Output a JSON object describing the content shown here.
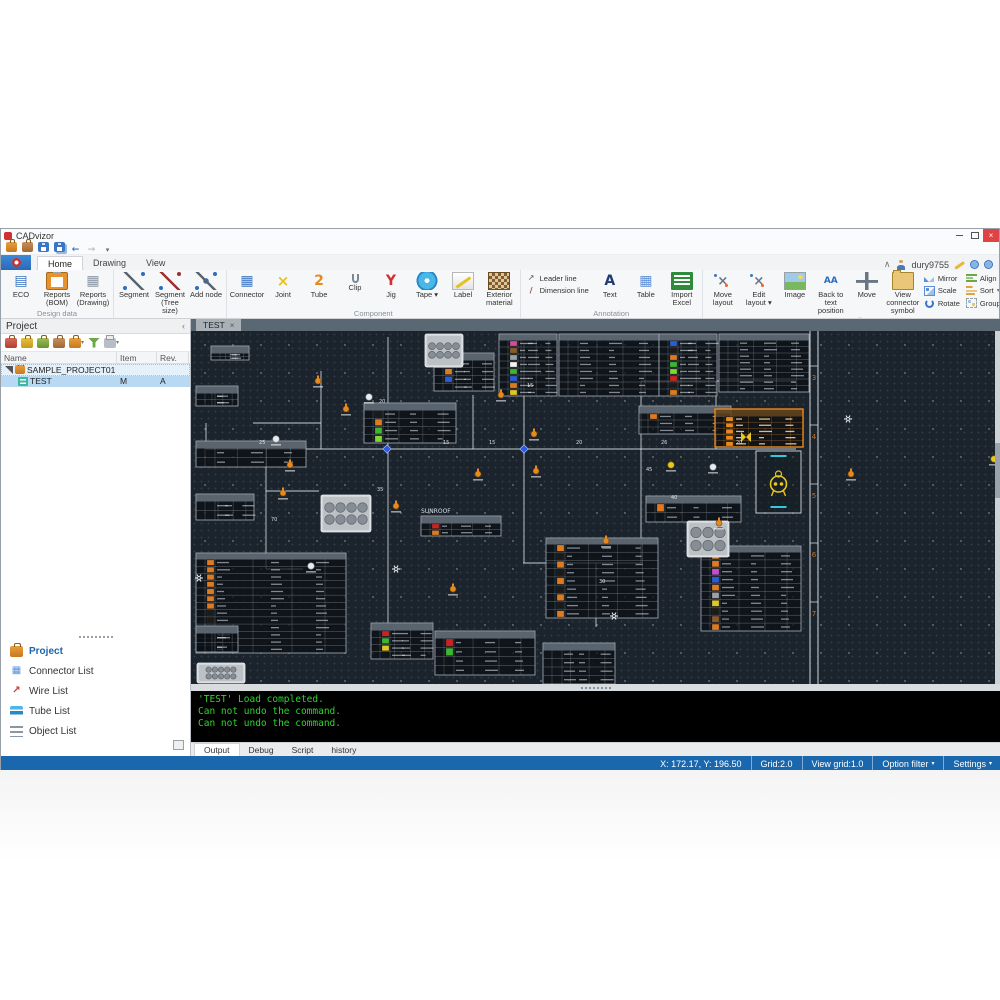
{
  "window": {
    "title": "CADvizor",
    "controls": {
      "minimize": "minimize",
      "restore": "restore",
      "close": "close"
    }
  },
  "quick_access": {
    "buttons": [
      {
        "name": "open",
        "icon": "open"
      },
      {
        "name": "import",
        "icon": "import"
      },
      {
        "name": "save",
        "icon": "save"
      },
      {
        "name": "save-all",
        "icon": "save-all"
      },
      {
        "name": "undo",
        "icon": "undo"
      },
      {
        "name": "redo",
        "icon": "redo"
      },
      {
        "name": "customize",
        "icon": "customize"
      }
    ]
  },
  "ribbon": {
    "tabs": [
      {
        "label": "Home",
        "active": true
      },
      {
        "label": "Drawing",
        "active": false
      },
      {
        "label": "View",
        "active": false
      }
    ],
    "account": {
      "collapse": "∧",
      "user": "dury9755"
    },
    "groups": [
      {
        "label": "Design data",
        "items": [
          {
            "label": "ECO",
            "icon": "eco"
          },
          {
            "label": "Reports (BOM)",
            "icon": "reports-bom"
          },
          {
            "label": "Reports (Drawing)",
            "icon": "reports-drawing"
          }
        ]
      },
      {
        "label": "Layout",
        "items": [
          {
            "label": "Segment",
            "icon": "segment"
          },
          {
            "label": "Segment (Tree size)",
            "icon": "segment-tree"
          },
          {
            "label": "Add node",
            "icon": "add-node"
          }
        ]
      },
      {
        "label": "Component",
        "items": [
          {
            "label": "Connector",
            "icon": "connector"
          },
          {
            "label": "Joint",
            "icon": "joint"
          },
          {
            "label": "Tube",
            "icon": "tube"
          },
          {
            "label": "Clip",
            "icon": "clip"
          },
          {
            "label": "Jig",
            "icon": "jig"
          },
          {
            "label": "Tape",
            "icon": "tape",
            "arrow": true
          },
          {
            "label": "Label",
            "icon": "label"
          },
          {
            "label": "Exterior material",
            "icon": "exterior"
          }
        ]
      },
      {
        "label": "Annotation",
        "items": [
          {
            "stack": [
              {
                "label": "Leader line",
                "icon": "leader-line"
              },
              {
                "label": "Dimension line",
                "icon": "dimension-line"
              }
            ]
          },
          {
            "label": "Text",
            "icon": "text"
          },
          {
            "label": "Table",
            "icon": "table"
          },
          {
            "label": "Import Excel",
            "icon": "import-excel"
          }
        ]
      },
      {
        "label": "Edit",
        "items": [
          {
            "label": "Move layout",
            "icon": "move-layout"
          },
          {
            "label": "Edit layout",
            "icon": "edit-layout",
            "arrow": true
          },
          {
            "label": "Image",
            "icon": "image"
          },
          {
            "label": "Back to text position",
            "icon": "back-text"
          },
          {
            "label": "Move",
            "icon": "move"
          },
          {
            "label": "View connector symbol",
            "icon": "view-connector"
          },
          {
            "stack": [
              {
                "label": "Mirror",
                "icon": "mirror"
              },
              {
                "label": "Scale",
                "icon": "scale"
              },
              {
                "label": "Rotate",
                "icon": "rotate"
              }
            ]
          },
          {
            "stack": [
              {
                "label": "Align",
                "icon": "align",
                "arrow": true
              },
              {
                "label": "Sort",
                "icon": "sort",
                "arrow": true
              },
              {
                "label": "Group",
                "icon": "group",
                "arrow": true
              }
            ]
          }
        ]
      },
      {
        "label": "Clipboard",
        "items": [
          {
            "label": "Copy",
            "icon": "copy"
          },
          {
            "label": "Paste",
            "icon": "paste"
          }
        ]
      },
      {
        "label": "Management",
        "items": [
          {
            "label": "Link",
            "icon": "link"
          }
        ]
      }
    ]
  },
  "project_panel": {
    "title": "Project",
    "collapse_glyph": "‹",
    "toolbar": [
      {
        "name": "new-project",
        "icon": "brief-red"
      },
      {
        "name": "open-project",
        "icon": "brief-yellow"
      },
      {
        "name": "sync-project",
        "icon": "brief-green"
      },
      {
        "name": "import-project",
        "icon": "brief-brown"
      },
      {
        "name": "export-project",
        "icon": "brief-orange",
        "arrow": true
      },
      {
        "name": "check-project",
        "icon": "filter"
      },
      {
        "name": "print-project",
        "icon": "printer",
        "arrow": true
      }
    ],
    "columns": [
      "Name",
      "Item",
      "Rev."
    ],
    "rows": [
      {
        "name": "SAMPLE_PROJECT01",
        "item": "",
        "rev": "",
        "level": 0,
        "icon": "brief-orange",
        "expanded": true,
        "selected": "light"
      },
      {
        "name": "TEST",
        "item": "M",
        "rev": "A",
        "level": 1,
        "icon": "doc-test",
        "selected": "full"
      }
    ],
    "nav": [
      {
        "label": "Project",
        "icon": "nav-project",
        "active": true
      },
      {
        "label": "Connector List",
        "icon": "nav-connector",
        "active": false
      },
      {
        "label": "Wire List",
        "icon": "nav-wire",
        "active": false
      },
      {
        "label": "Tube List",
        "icon": "nav-tube",
        "active": false
      },
      {
        "label": "Object List",
        "icon": "nav-object",
        "active": false
      }
    ]
  },
  "document_tabs": [
    {
      "label": "TEST",
      "close_glyph": "×",
      "active": true
    }
  ],
  "console": {
    "lines": [
      "'TEST' Load completed.",
      "Can not undo the command.",
      "Can not undo the command."
    ],
    "text_color": "#2fd42f",
    "tabs": [
      {
        "label": "Output",
        "active": true
      },
      {
        "label": "Debug",
        "active": false
      },
      {
        "label": "Script",
        "active": false
      },
      {
        "label": "history",
        "active": false
      }
    ]
  },
  "status_bar": {
    "background": "#1a67ad",
    "items": [
      {
        "label": "X: 172.17, Y: 196.50"
      },
      {
        "label": "Grid:2.0"
      },
      {
        "label": "View grid:1.0"
      },
      {
        "label": "Option filter",
        "arrow": true
      },
      {
        "label": "Settings",
        "arrow": true
      }
    ]
  },
  "canvas_scene": {
    "bg": "#1b232d",
    "line_color": "#e7ecf0",
    "frame": {
      "x1": 619,
      "x2": 627,
      "color": "#cfd4d8",
      "zone_color": "#c87820",
      "zones": [
        {
          "t": "3",
          "y": 49
        },
        {
          "t": "4",
          "y": 108
        },
        {
          "t": "5",
          "y": 167
        },
        {
          "t": "6",
          "y": 226
        },
        {
          "t": "7",
          "y": 285
        }
      ]
    },
    "segments": [
      [
        15,
        118,
        605,
        118
      ],
      [
        15,
        92,
        15,
        118
      ],
      [
        62,
        92,
        130,
        92
      ],
      [
        130,
        40,
        130,
        118
      ],
      [
        197,
        6,
        197,
        292
      ],
      [
        282,
        64,
        282,
        118
      ],
      [
        333,
        12,
        333,
        232
      ],
      [
        450,
        50,
        450,
        232
      ],
      [
        450,
        50,
        605,
        50
      ],
      [
        525,
        50,
        525,
        118
      ],
      [
        332,
        232,
        452,
        232
      ],
      [
        405,
        232,
        405,
        296
      ],
      [
        75,
        118,
        75,
        238
      ],
      [
        75,
        160,
        128,
        160
      ],
      [
        75,
        238,
        112,
        238
      ]
    ],
    "labels": [
      {
        "t": "25",
        "x": 68,
        "y": 113
      },
      {
        "t": "15",
        "x": 252,
        "y": 113
      },
      {
        "t": "15",
        "x": 298,
        "y": 113
      },
      {
        "t": "20",
        "x": 385,
        "y": 113
      },
      {
        "t": "26",
        "x": 470,
        "y": 113
      },
      {
        "t": "20",
        "x": 545,
        "y": 113
      },
      {
        "t": "20",
        "x": 188,
        "y": 72
      },
      {
        "t": "35",
        "x": 186,
        "y": 160
      },
      {
        "t": "15",
        "x": 336,
        "y": 56
      },
      {
        "t": "45",
        "x": 455,
        "y": 140
      },
      {
        "t": "40",
        "x": 480,
        "y": 168
      },
      {
        "t": "30",
        "x": 408,
        "y": 252
      },
      {
        "t": "70",
        "x": 80,
        "y": 190
      },
      {
        "t": "SUNROOF",
        "x": 230,
        "y": 182,
        "f": 6
      }
    ],
    "nodes": [
      {
        "k": "clip",
        "x": 127,
        "y": 50
      },
      {
        "k": "clip",
        "x": 155,
        "y": 78
      },
      {
        "k": "clip",
        "x": 99,
        "y": 134
      },
      {
        "k": "clip",
        "x": 92,
        "y": 162
      },
      {
        "k": "clip",
        "x": 205,
        "y": 175
      },
      {
        "k": "clip",
        "x": 287,
        "y": 143
      },
      {
        "k": "clip",
        "x": 343,
        "y": 103
      },
      {
        "k": "clip",
        "x": 345,
        "y": 140
      },
      {
        "k": "clip",
        "x": 415,
        "y": 210
      },
      {
        "k": "clip",
        "x": 262,
        "y": 258
      },
      {
        "k": "clip",
        "x": 528,
        "y": 192
      },
      {
        "k": "clip",
        "x": 660,
        "y": 143
      },
      {
        "k": "clip",
        "x": 310,
        "y": 64
      },
      {
        "k": "wc",
        "x": 178,
        "y": 66
      },
      {
        "k": "wc",
        "x": 85,
        "y": 108
      },
      {
        "k": "wc",
        "x": 120,
        "y": 235
      },
      {
        "k": "wc",
        "x": 522,
        "y": 136
      },
      {
        "k": "yc",
        "x": 480,
        "y": 134
      },
      {
        "k": "yc",
        "x": 803,
        "y": 128
      },
      {
        "k": "gear",
        "x": 205,
        "y": 238
      },
      {
        "k": "gear",
        "x": 423,
        "y": 285
      },
      {
        "k": "gear",
        "x": 8,
        "y": 247
      },
      {
        "k": "gear",
        "x": 657,
        "y": 88
      },
      {
        "k": "bd",
        "x": 196,
        "y": 118
      },
      {
        "k": "bd",
        "x": 333,
        "y": 118
      },
      {
        "k": "bt",
        "x": 555,
        "y": 106
      }
    ],
    "tables": [
      [
        20,
        15,
        38,
        14,
        2,
        "w",
        []
      ],
      [
        243,
        22,
        60,
        38,
        4,
        "w",
        [
          "#1a1a1a",
          "#e07a1e",
          "#2b5cd8"
        ]
      ],
      [
        308,
        3,
        58,
        62,
        8,
        "w",
        [
          "#d84a9a",
          "#8a5a2a",
          "#9aa0a6",
          "#f5f5f5",
          "#3cb82e",
          "#2b5cd8",
          "#e07a1e",
          "#e0c822"
        ]
      ],
      [
        368,
        3,
        100,
        62,
        8,
        "w",
        []
      ],
      [
        468,
        3,
        58,
        62,
        8,
        "w",
        [
          "#2b5cd8",
          "#1a1a1a",
          "#e07a1e",
          "#3cb82e",
          "#7ed82e",
          "#cc2222",
          "#1a1a1a",
          "#e07a1e"
        ]
      ],
      [
        528,
        3,
        90,
        58,
        8,
        "w",
        []
      ],
      [
        448,
        75,
        92,
        28,
        3,
        "w",
        [
          "#e07a1e"
        ]
      ],
      [
        524,
        78,
        88,
        38,
        5,
        "o",
        [
          "#e8891e",
          "#e8891e",
          "#e8891e",
          "#e8891e",
          "#e8891e"
        ]
      ],
      [
        173,
        72,
        92,
        40,
        4,
        "w",
        [
          "#1a1a1a",
          "#e07a1e",
          "#3cb82e",
          "#7ed82e"
        ]
      ],
      [
        230,
        185,
        80,
        20,
        2,
        "w",
        [
          "#cc2222",
          "#e07a1e"
        ]
      ],
      [
        455,
        165,
        95,
        26,
        2,
        "w",
        [
          "#e07a1e"
        ]
      ],
      [
        355,
        207,
        112,
        80,
        9,
        "w",
        [
          "#e07a1e",
          "#1a1a1a",
          "#e07a1e",
          "#1a1a1a",
          "#e07a1e",
          "#1a1a1a",
          "#e07a1e",
          "#1a1a1a",
          "#e07a1e"
        ]
      ],
      [
        510,
        215,
        100,
        85,
        10,
        "w",
        [
          "#e07a1e",
          "#e07a1e",
          "#c050c8",
          "#2b5cd8",
          "#e07a1e",
          "#9aa0a6",
          "#e0c822",
          "#1a1a1a",
          "#8a5a2a",
          "#e07a1e"
        ]
      ],
      [
        5,
        222,
        150,
        100,
        13,
        "w",
        [
          "#e07a1e",
          "#e07a1e",
          "#e07a1e",
          "#e07a1e",
          "#e07a1e",
          "#e07a1e",
          "#e07a1e",
          "#1a1a1a",
          "#1a1a1a",
          "#1a1a1a",
          "#1a1a1a",
          "#1a1a1a",
          "#1a1a1a"
        ]
      ],
      [
        5,
        110,
        110,
        26,
        2,
        "w",
        []
      ],
      [
        5,
        163,
        58,
        26,
        2,
        "w",
        []
      ],
      [
        5,
        55,
        42,
        20,
        2,
        "w",
        []
      ],
      [
        180,
        292,
        62,
        36,
        4,
        "w",
        [
          "#cc2222",
          "#3cb82e",
          "#e0c822"
        ]
      ],
      [
        244,
        300,
        100,
        44,
        4,
        "w",
        [
          "#cc2222",
          "#3cb82e"
        ]
      ],
      [
        352,
        312,
        72,
        41,
        4,
        "w",
        []
      ],
      [
        5,
        295,
        42,
        26,
        2,
        "w",
        []
      ]
    ],
    "photos": [
      {
        "x": 234,
        "y": 3,
        "w": 38,
        "h": 33,
        "c": 8
      },
      {
        "x": 130,
        "y": 164,
        "w": 50,
        "h": 37,
        "c": 8
      },
      {
        "x": 496,
        "y": 190,
        "w": 42,
        "h": 36,
        "c": 6
      },
      {
        "x": 6,
        "y": 332,
        "w": 48,
        "h": 20,
        "c": 10
      }
    ],
    "symbol_box": {
      "x": 565,
      "y": 120,
      "w": 45,
      "h": 62,
      "glyph_color": "#e8c81e",
      "accent": "#35c8d8"
    }
  }
}
